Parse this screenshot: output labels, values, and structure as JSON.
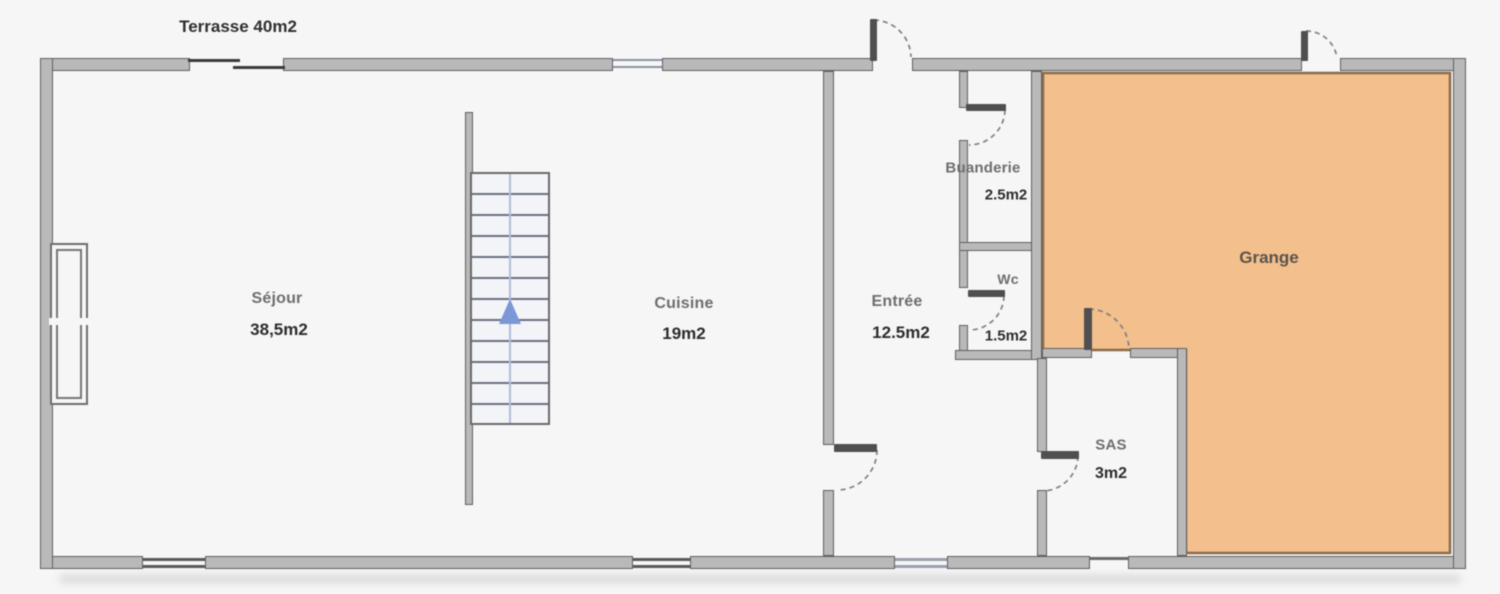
{
  "plan_title": "Floor plan (rez-de-chaussée)",
  "colors": {
    "background": "#f6f6f6",
    "wall_fill": "#b9b9b9",
    "wall_outline": "#5f5f5f",
    "grange_fill": "#f3bf8d",
    "grange_border": "#8a6b4a",
    "stair_arrow": "#7b97d6",
    "door_dash": "#808080"
  },
  "labels": {
    "terrasse": {
      "name": "Terrasse 40m2"
    },
    "sejour": {
      "name": "Séjour",
      "area": "38,5m2"
    },
    "cuisine": {
      "name": "Cuisine",
      "area": "19m2"
    },
    "entree": {
      "name": "Entrée",
      "area": "12.5m2"
    },
    "buanderie": {
      "name": "Buanderie",
      "area": "2.5m2"
    },
    "wc": {
      "name": "Wc",
      "area": "1.5m2"
    },
    "sas": {
      "name": "SAS",
      "area": "3m2"
    },
    "grange": {
      "name": "Grange"
    }
  }
}
